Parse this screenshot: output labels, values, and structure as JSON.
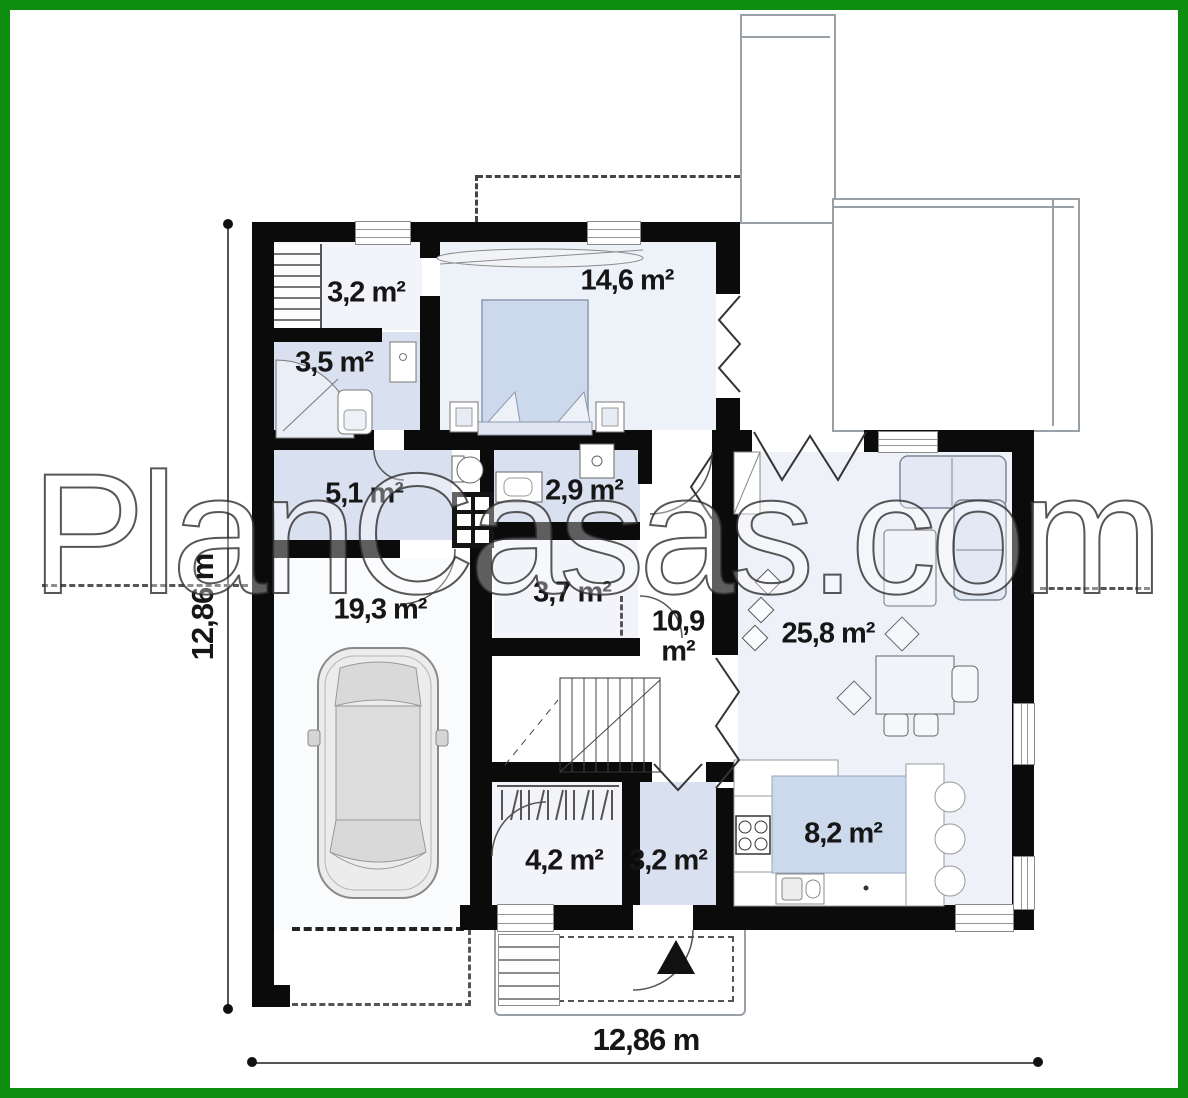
{
  "watermark": "PlanCasas.com",
  "colors": {
    "frame_green": "#0e8e0e",
    "wall_black": "#0b0b0b",
    "room_tint_blue": "#d9e1f0",
    "furniture_blue": "#ccd8ec",
    "label_text": "#161616"
  },
  "dimensions": {
    "bottom_label": "12,86 m",
    "left_label": "12,86 m"
  },
  "rooms": [
    {
      "id": "wardrobe-top",
      "area": "3,2 m²"
    },
    {
      "id": "bedroom",
      "area": "14,6 m²"
    },
    {
      "id": "bathroom",
      "area": "3,5 m²"
    },
    {
      "id": "corridor",
      "area": "5,1 m²"
    },
    {
      "id": "wc",
      "area": "2,9 m²"
    },
    {
      "id": "garage",
      "area": "19,3 m²"
    },
    {
      "id": "pantry",
      "area": "3,7 m²"
    },
    {
      "id": "hall",
      "area": "10,9\nm²"
    },
    {
      "id": "living-room",
      "area": "25,8 m²"
    },
    {
      "id": "wardrobe-entry",
      "area": "4,2 m²"
    },
    {
      "id": "entry",
      "area": "3,2 m²"
    },
    {
      "id": "kitchen",
      "area": "8,2 m²"
    }
  ]
}
